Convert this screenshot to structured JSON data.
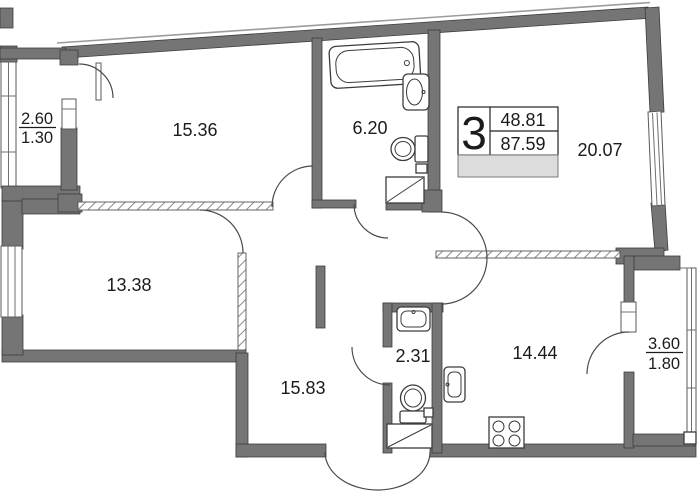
{
  "plan": {
    "rooms": [
      {
        "name": "bedroom-top-left",
        "area": "15.36"
      },
      {
        "name": "bathroom",
        "area": "6.20"
      },
      {
        "name": "living-room",
        "area": "20.07"
      },
      {
        "name": "bedroom-bottom-left",
        "area": "13.38"
      },
      {
        "name": "hallway",
        "area": "15.83"
      },
      {
        "name": "wc",
        "area": "2.31"
      },
      {
        "name": "kitchen",
        "area": "14.44"
      }
    ],
    "balconies": [
      {
        "name": "balcony-left",
        "full": "2.60",
        "reduced": "1.30"
      },
      {
        "name": "balcony-right",
        "full": "3.60",
        "reduced": "1.80"
      }
    ],
    "info_box": {
      "rooms_count": "3",
      "living_area": "48.81",
      "total_area": "87.59"
    }
  },
  "colors": {
    "wall": "#757575",
    "wall_outline": "#3e3e3e",
    "hatch": "#8a8a8a",
    "info_fill": "#dcdcdc",
    "background": "#ffffff"
  }
}
